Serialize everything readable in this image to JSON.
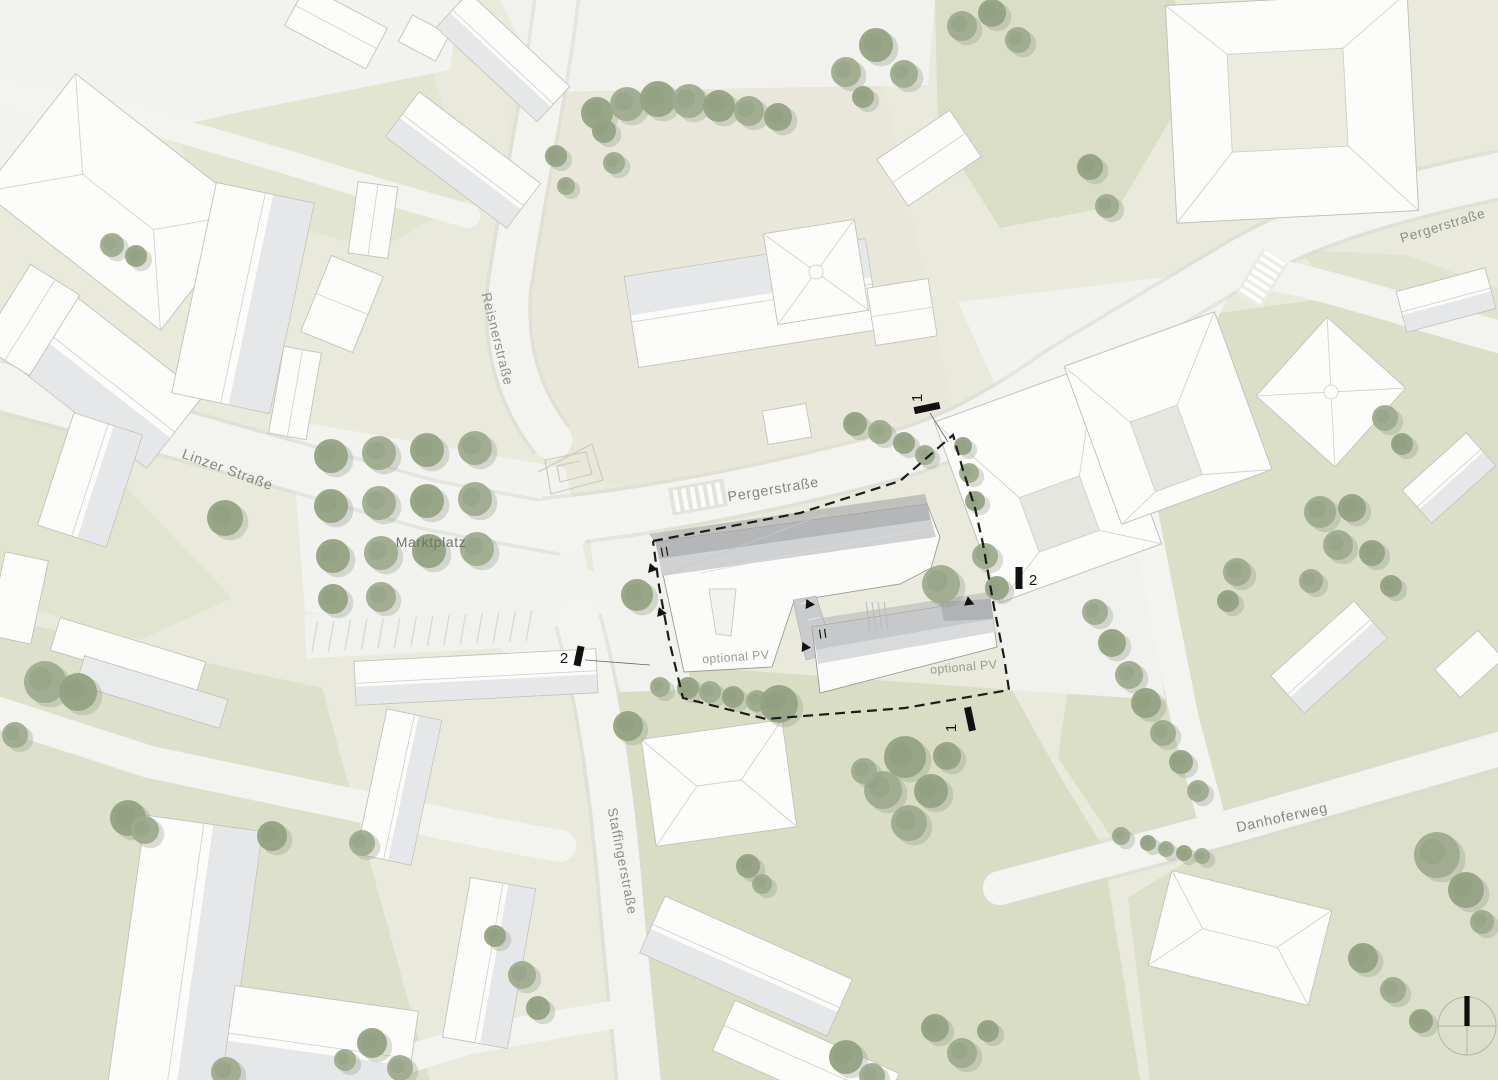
{
  "map": {
    "title": "site-plan",
    "streets": {
      "reisnerstrasse": "Reisnerstraße",
      "linzer_strasse": "Linzer Straße",
      "marktplatz": "Marktplatz",
      "pergerstrasse_center": "Pergerstraße",
      "pergerstrasse_ne": "Pergerstraße",
      "staffingerstrasse": "Staffingerstraße",
      "danhoferweg": "Danhoferweg"
    },
    "annotations": {
      "optional_pv_west": "optional PV",
      "optional_pv_east": "optional PV",
      "section_1_top": "1",
      "section_1_bottom": "1",
      "section_2_left": "2",
      "section_2_right": "2",
      "level_marker_west": "II",
      "level_marker_east": "II"
    },
    "icons": {
      "north_arrow": "compass-north-arrow-icon"
    },
    "colors": {
      "ground_beige": "#e9e9dc",
      "lawn_green": "#dce0c9",
      "street_white": "#f3f3f0",
      "tree_green": "#9aa78a",
      "building_white": "#fcfcfa",
      "project_roof_gray": "#c9cbcd",
      "boundary_dashed": "#1c1c1c",
      "label_gray": "#8d8e87"
    }
  }
}
